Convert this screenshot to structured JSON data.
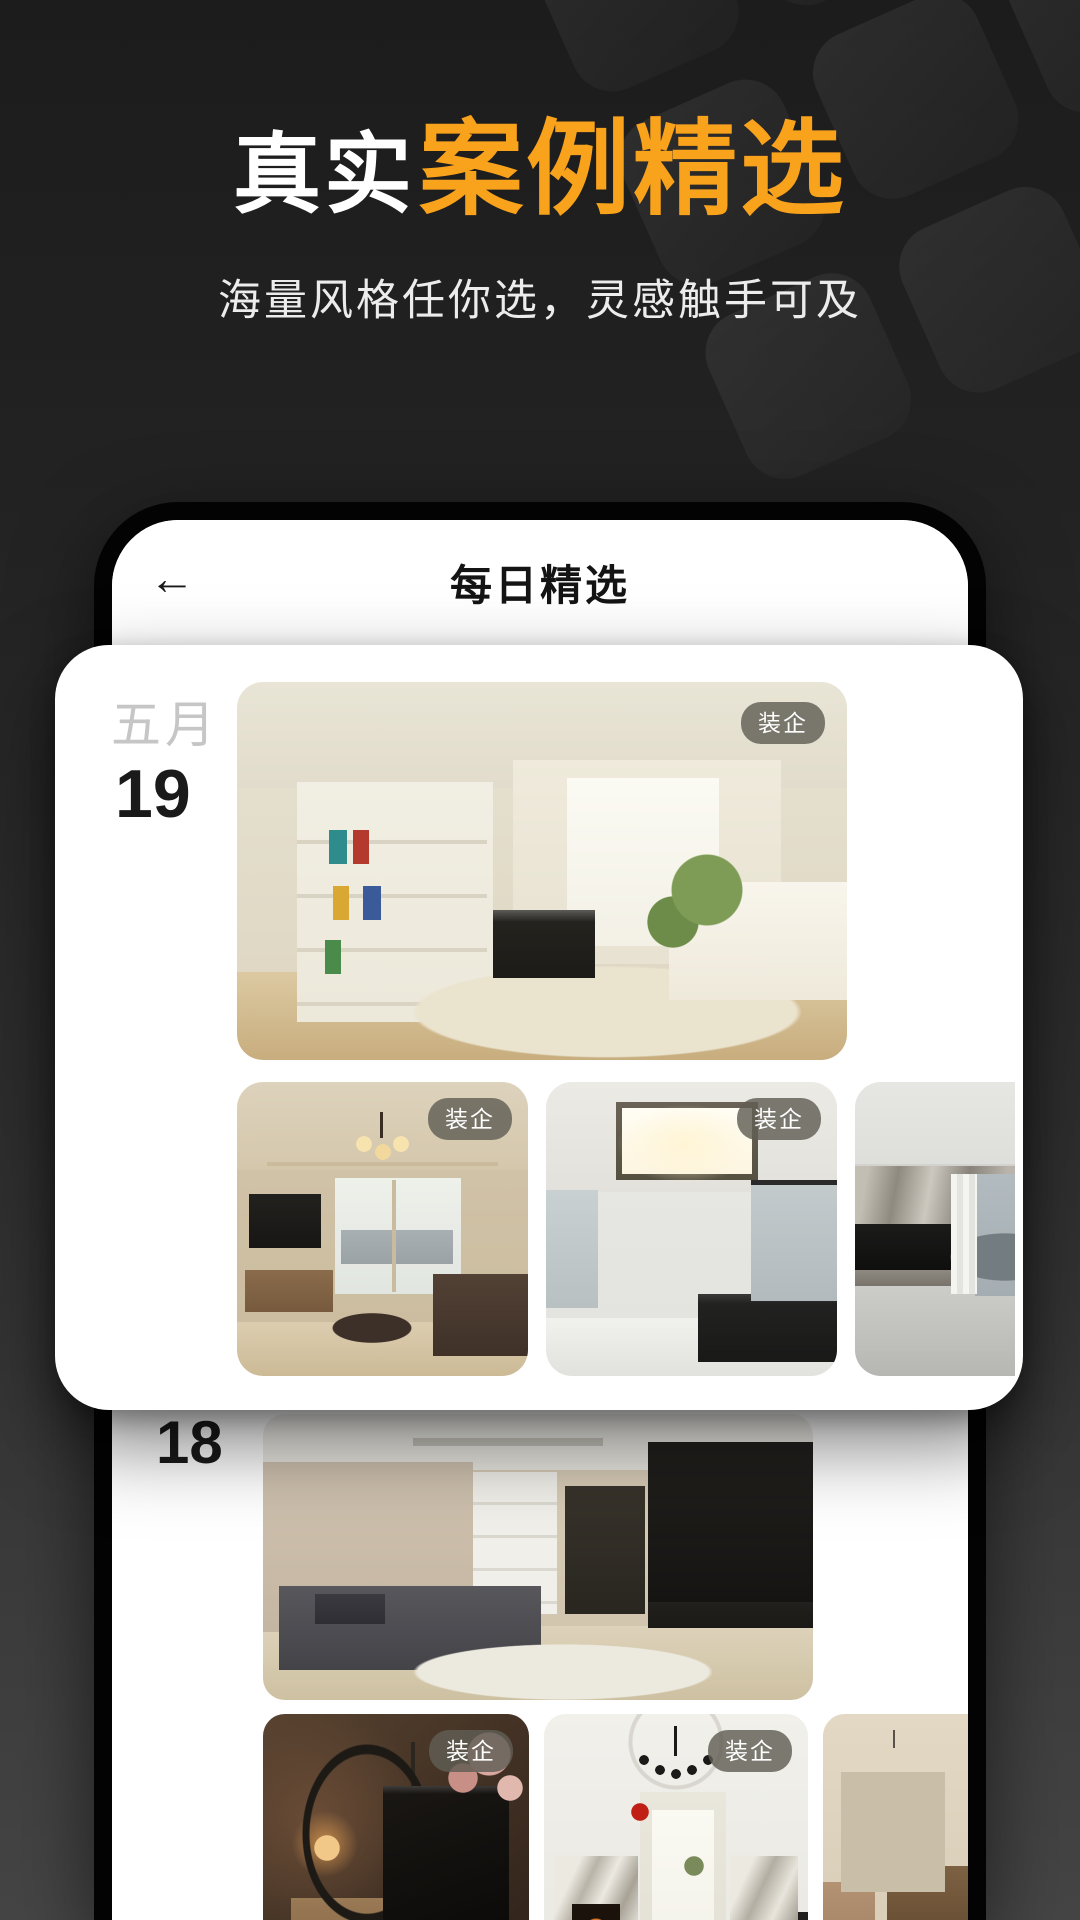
{
  "hero": {
    "title_prefix": "真实",
    "title_main": "案例精选",
    "subtitle": "海量风格任你选，灵感触手可及",
    "accent_color": "#F9A21B"
  },
  "phone": {
    "header": {
      "back_icon": "arrow-left",
      "title": "每日精选"
    },
    "badge_label": "装企",
    "badge_bg": "rgba(96,94,84,0.82)",
    "sections": [
      {
        "month": "五月",
        "day": "19",
        "photos": [
          {
            "name": "cream-living-room-bookshelf",
            "badge": true
          },
          {
            "name": "warm-living-room-chandelier",
            "badge": true
          },
          {
            "name": "white-living-room-ceiling-light",
            "badge": true
          },
          {
            "name": "grey-living-room-mountain-view",
            "badge": false
          }
        ]
      },
      {
        "month": "",
        "day": "18",
        "photos": [
          {
            "name": "modern-apartment-black-media-wall",
            "badge": false
          },
          {
            "name": "warm-arched-glass-partition",
            "badge": true
          },
          {
            "name": "classic-white-room-chandelier",
            "badge": true
          },
          {
            "name": "beige-room-window-speaker",
            "badge": false
          }
        ]
      }
    ]
  }
}
